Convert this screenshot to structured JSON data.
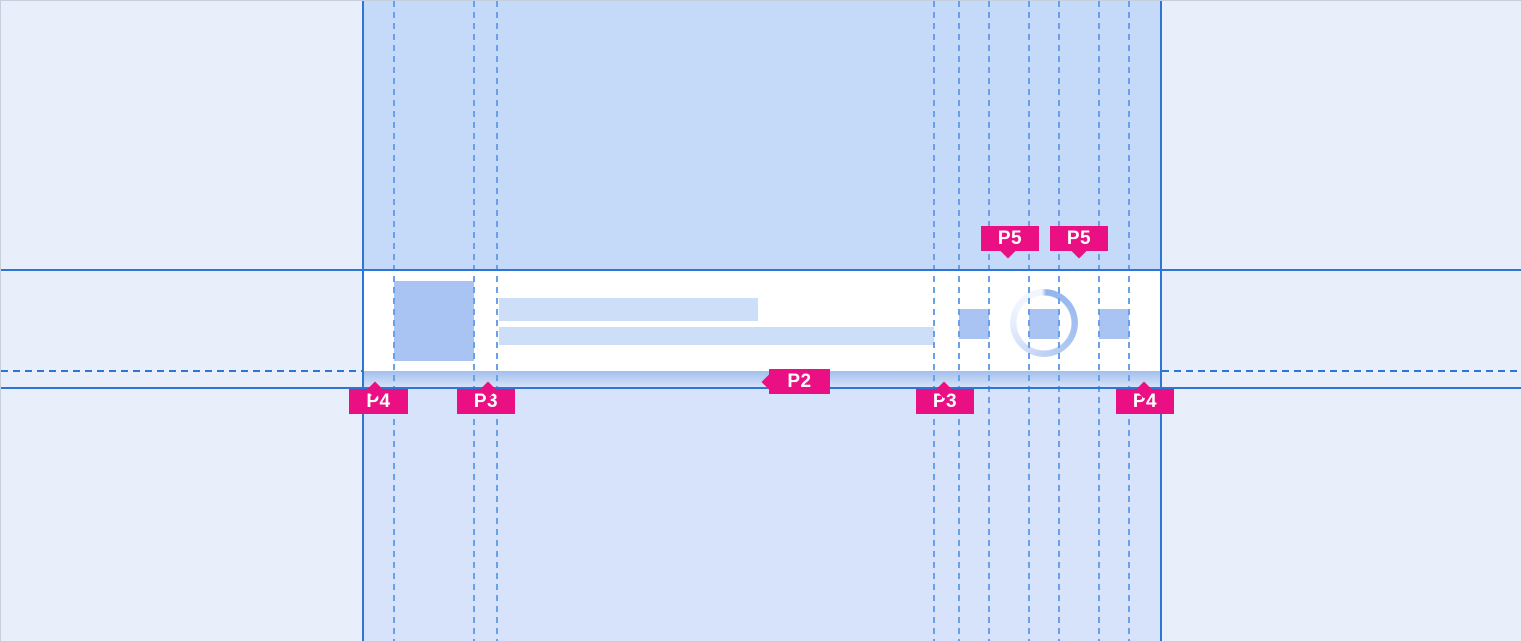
{
  "annotations": {
    "p4_left": "P4",
    "p3_left": "P3",
    "p2": "P2",
    "p5_first": "P5",
    "p5_second": "P5",
    "p3_right": "P3",
    "p4_right": "P4"
  },
  "colors": {
    "background": "#E9EEFB",
    "band_top": "#C5DAF8",
    "band_bottom": "#D6E3FA",
    "surface": "#FFFFFF",
    "placeholder_dark": "#A9C4F2",
    "placeholder_light": "#CDDEF8",
    "guide_blue": "#2E76D6",
    "guide_dashed": "#6AA0EA",
    "accent_pink": "#EA0F82",
    "p2_gradient_top": "#A2BFEE",
    "p2_gradient_bottom": "#D6E2F9"
  }
}
